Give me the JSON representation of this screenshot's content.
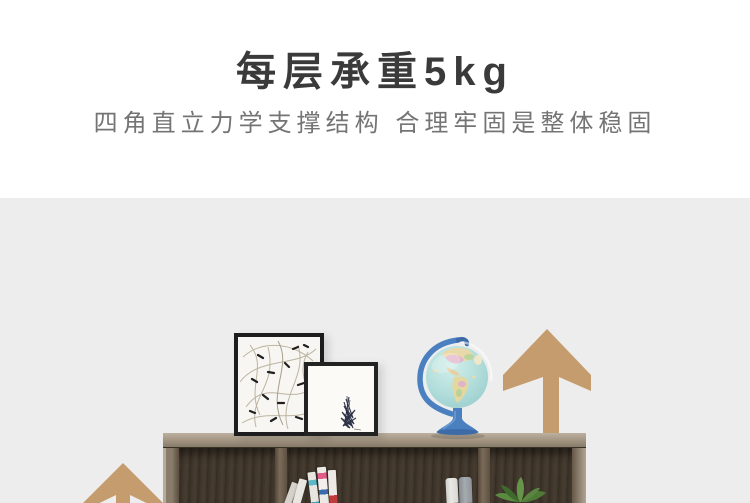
{
  "header": {
    "title": "每层承重5kg",
    "subtitle": "四角直立力学支撑结构 合理牢固是整体稳固"
  },
  "scene": {
    "colors": {
      "background": "#ededed",
      "arrow": "#c59c6e",
      "shelf_top": "#a1937f",
      "shelf_interior": "#3f352a",
      "frame_border": "#1d1d1d",
      "frame_canvas": "#f7f6f2",
      "sketch_ink": "#2d3247",
      "globe_ocean": "#b5dfdc",
      "globe_stand": "#4a7fc0",
      "plant_green": "#4e7a36",
      "binder_white": "#e4e3e0",
      "binder_gray": "#9aa0a4"
    },
    "books": [
      {
        "color": "#d6d2cb"
      },
      {
        "color": "#e9e6e1"
      },
      {
        "color": "#59b8c9"
      },
      {
        "color": "#e05a8a"
      },
      {
        "color": "#c23b3b"
      }
    ]
  }
}
